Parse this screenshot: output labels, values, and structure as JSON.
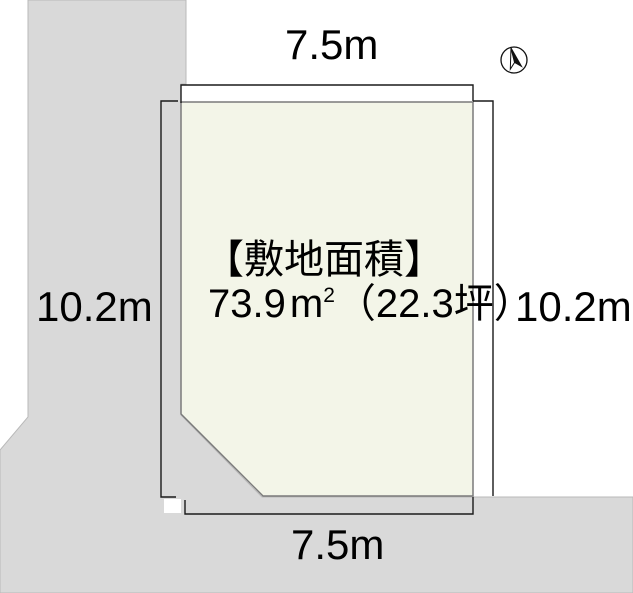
{
  "dimensions": {
    "top_width": "7.5m",
    "bottom_width": "7.5m",
    "left_depth": "10.2m",
    "right_depth": "10.2m"
  },
  "site_area": {
    "heading": "【敷地面積】",
    "value": "73.9",
    "unit_base": "m",
    "unit_exponent": "2",
    "tsubo_part": "（22.3坪）"
  },
  "colors": {
    "plot_fill": "#f3f5e8",
    "surrounding_fill": "#d9d9d9",
    "dimension_line": "#1a1a1a",
    "text": "#000000"
  }
}
